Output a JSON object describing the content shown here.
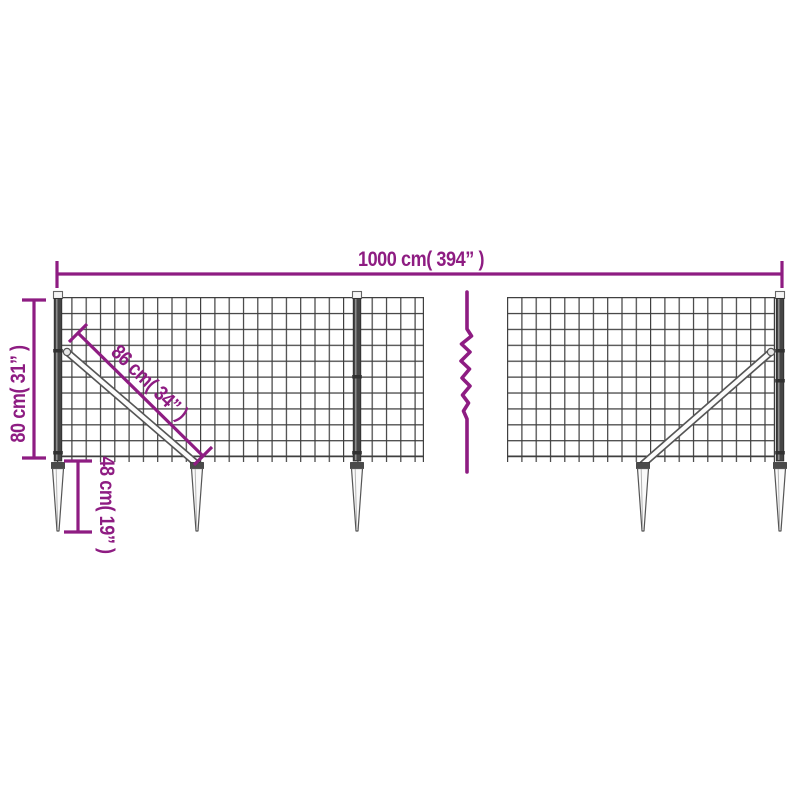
{
  "page": {
    "background": "#ffffff",
    "title": "Wire mesh fence dimension diagram"
  },
  "theme": {
    "page-bg": "#ffffff",
    "dimension-color": "#8e1c82",
    "wire-color": "#3f3f3f",
    "steel-dark": "#454545",
    "steel-outline": "#555555",
    "steel-light": "#fafafa"
  },
  "diagram": {
    "type": "product-dimension-diagram",
    "subject": "wire mesh fence with posts, diagonal braces and pointed ground spike anchors, middle section broken by a continuation squiggle",
    "dimensions": {
      "total_width": {
        "label": "1000 cm( 394” )",
        "cm": 1000,
        "inches": 394
      },
      "fence_height": {
        "label": "80 cm( 31” )",
        "cm": 80,
        "inches": 31
      },
      "brace_length": {
        "label": "86 cm( 34” )",
        "cm": 86,
        "inches": 34
      },
      "spike_length": {
        "label": "48 cm( 19” )",
        "cm": 48,
        "inches": 19
      }
    }
  }
}
